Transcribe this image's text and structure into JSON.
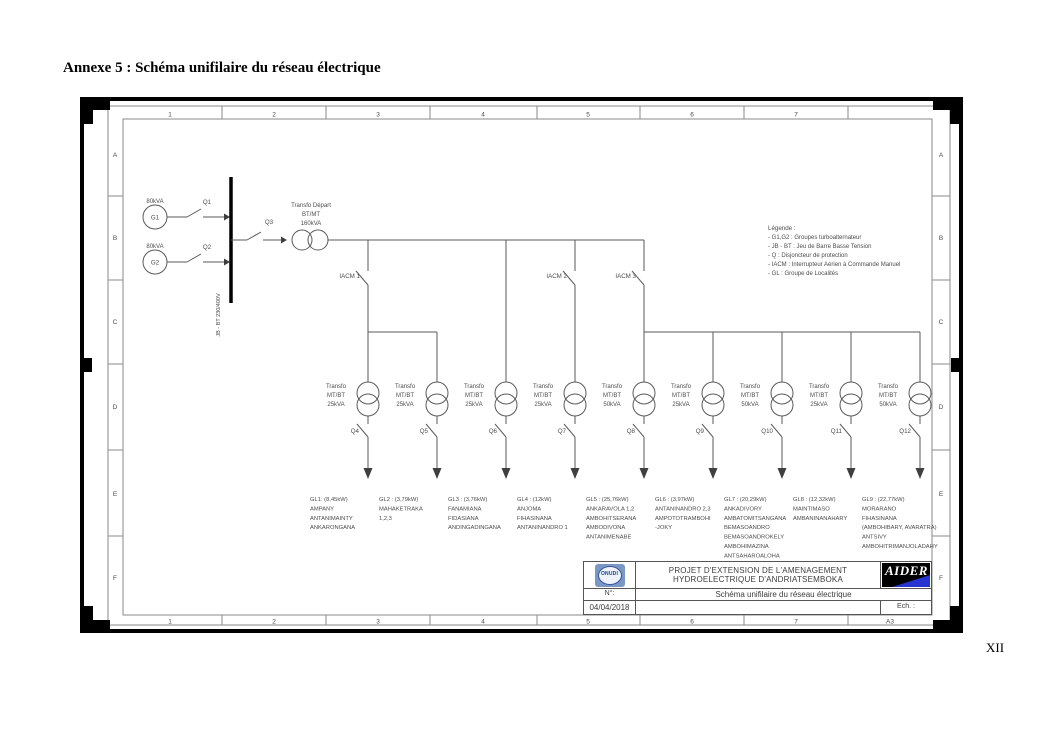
{
  "page": {
    "annex_title": "Annexe 5 : Schéma unifilaire du réseau électrique",
    "page_number": "XII"
  },
  "frame": {
    "column_labels": [
      "1",
      "2",
      "3",
      "4",
      "5",
      "6",
      "7"
    ],
    "row_labels": [
      "A",
      "B",
      "C",
      "D",
      "E",
      "F"
    ],
    "format_label": "A3"
  },
  "legend": {
    "title": "Légende :",
    "items": [
      "- G1,G2 : Groupes turboalternateur",
      "- JB - BT : Jeu de Barre Basse Tension",
      "- Q : Disjoncteur de protection",
      "- IACM : Interrupteur Aérien à Commande Manuel",
      "- GL : Groupe de Localités"
    ]
  },
  "source": {
    "generators": [
      {
        "name": "G1",
        "rating": "80kVA",
        "breaker": "Q1"
      },
      {
        "name": "G2",
        "rating": "80kVA",
        "breaker": "Q2"
      }
    ],
    "busbar_label": "JB - BT 230/400V",
    "departure_breaker": "Q3",
    "departure_transformer": [
      "Transfo Départ",
      "BT/MT",
      "160kVA"
    ]
  },
  "feeders": [
    "IACM 1",
    "IACM 2",
    "IACM 3"
  ],
  "branches": [
    {
      "transformer": [
        "Transfo",
        "MT/BT",
        "25kVA"
      ],
      "breaker": "Q4",
      "group": [
        "GL1: (8,45kW)",
        "AMPANY",
        "ANTANIMAINTY",
        "ANKARONGANA"
      ]
    },
    {
      "transformer": [
        "Transfo",
        "MT/BT",
        "25kVA"
      ],
      "breaker": "Q5",
      "group": [
        "GL2 : (3,79kW)",
        "MAHAKETRAKA",
        "1,2,3"
      ]
    },
    {
      "transformer": [
        "Transfo",
        "MT/BT",
        "25kVA"
      ],
      "breaker": "Q6",
      "group": [
        "GL3 : (3,76kW)",
        "FANAMIANA",
        "FIDASIANA",
        "ANDINGADINGANA"
      ]
    },
    {
      "transformer": [
        "Transfo",
        "MT/BT",
        "25kVA"
      ],
      "breaker": "Q7",
      "group": [
        "GL4 : (12kW)",
        "ANJOMA",
        "FIHASINANA",
        "ANTANINANDRO 1"
      ]
    },
    {
      "transformer": [
        "Transfo",
        "MT/BT",
        "50kVA"
      ],
      "breaker": "Q8",
      "group": [
        "GL5 : (25,76kW)",
        "ANKARAVOLA 1,2",
        "AMBOHITSERANA",
        "AMBODIVONA",
        "ANTANIMENABE"
      ]
    },
    {
      "transformer": [
        "Transfo",
        "MT/BT",
        "25kVA"
      ],
      "breaker": "Q9",
      "group": [
        "GL6 : (3,97kW)",
        "ANTANINANDRO 2,3",
        "AMPOTOTRAMBOHI",
        "-JOKY"
      ]
    },
    {
      "transformer": [
        "Transfo",
        "MT/BT",
        "50kVA"
      ],
      "breaker": "Q10",
      "group": [
        "GL7 : (20,29kW)",
        "ANKADIVORY",
        "AMBATOMITSANGANA",
        "BEMASOANDRO",
        "BEMASOANDROKELY",
        "AMBOHIMAZINA",
        "ANTSAHAROALOHA"
      ]
    },
    {
      "transformer": [
        "Transfo",
        "MT/BT",
        "25kVA"
      ],
      "breaker": "Q11",
      "group": [
        "GL8 : (12,32kW)",
        "MAINTIMASO",
        "AMBANINANAHARY"
      ]
    },
    {
      "transformer": [
        "Transfo",
        "MT/BT",
        "50kVA"
      ],
      "breaker": "Q12",
      "group": [
        "GL9 : (22,77kW)",
        "MORARANO",
        "FIHASINANA",
        "(AMBOHIBARY, AVARATRA)",
        "ANTSIVY",
        "AMBOHITRIMANJOLADAHY"
      ]
    }
  ],
  "title_block": {
    "project_title_line1": "PROJET D'EXTENSION DE L'AMENAGEMENT",
    "project_title_line2": "HYDROELECTRIQUE D'ANDRIATSEMBOKA",
    "number_label": "N°:",
    "drawing_title": "Schéma unifilaire du réseau électrique",
    "date": "04/04/2018",
    "scale_label": "Ech. :",
    "logos": {
      "left": "ONUDI",
      "right": "AIDER"
    }
  },
  "colors": {
    "aider_blue": "#2734cf",
    "onudi_blue": "#7b97c6",
    "line_gray": "#5a5a5a"
  }
}
